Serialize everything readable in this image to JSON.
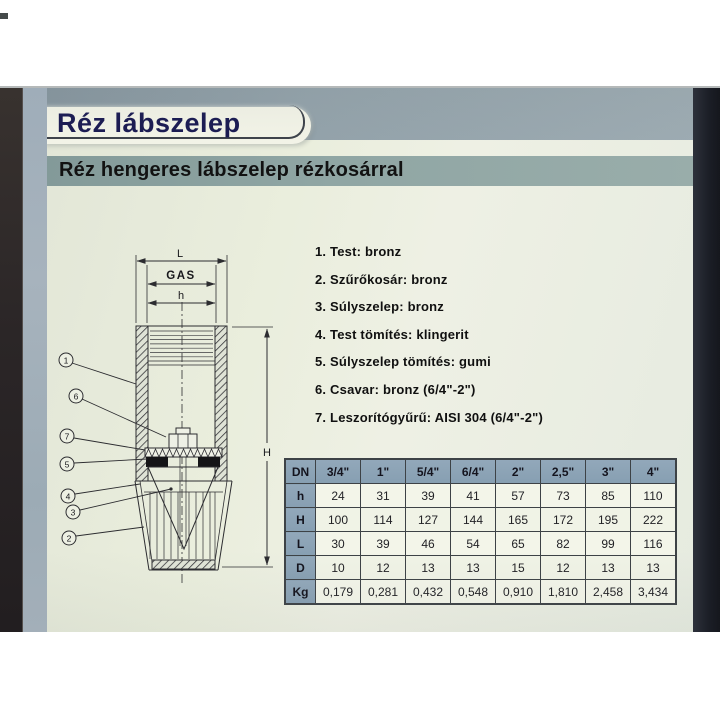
{
  "header": {
    "title": "Réz lábszelep",
    "subtitle": "Réz hengeres lábszelep rézkosárral"
  },
  "parts_list": {
    "items": [
      "1. Test: bronz",
      "2. Szűrőkosár: bronz",
      "3. Súlyszelep: bronz",
      "4. Test tömítés: klingerit",
      "5. Súlyszelep tömítés: gumi",
      "6. Csavar: bronz (6/4\"-2\")",
      "7. Leszorítógyűrű: AISI 304 (6/4\"-2\")"
    ]
  },
  "drawing": {
    "dimensions": {
      "outer_width": "L",
      "thread": "GAS",
      "inner_width": "h",
      "height": "H"
    },
    "callouts": [
      "1",
      "6",
      "7",
      "5",
      "4",
      "3",
      "2"
    ]
  },
  "table": {
    "header": [
      "DN",
      "3/4\"",
      "1\"",
      "5/4\"",
      "6/4\"",
      "2\"",
      "2,5\"",
      "3\"",
      "4\""
    ],
    "rows": [
      {
        "label": "h",
        "values": [
          "24",
          "31",
          "39",
          "41",
          "57",
          "73",
          "85",
          "110"
        ]
      },
      {
        "label": "H",
        "values": [
          "100",
          "114",
          "127",
          "144",
          "165",
          "172",
          "195",
          "222"
        ]
      },
      {
        "label": "L",
        "values": [
          "30",
          "39",
          "46",
          "54",
          "65",
          "82",
          "99",
          "116"
        ]
      },
      {
        "label": "D",
        "values": [
          "10",
          "12",
          "13",
          "13",
          "15",
          "12",
          "13",
          "13"
        ]
      },
      {
        "label": "Kg",
        "values": [
          "0,179",
          "0,281",
          "0,432",
          "0,548",
          "0,910",
          "1,810",
          "2,458",
          "3,434"
        ]
      }
    ]
  },
  "colors": {
    "title_text": "#1a1a52",
    "header_band": "#93a2aa",
    "subtitle_band": "#90a6a4",
    "table_header_bg": "#8ba2b4",
    "page_bg": "#eaeedd"
  }
}
